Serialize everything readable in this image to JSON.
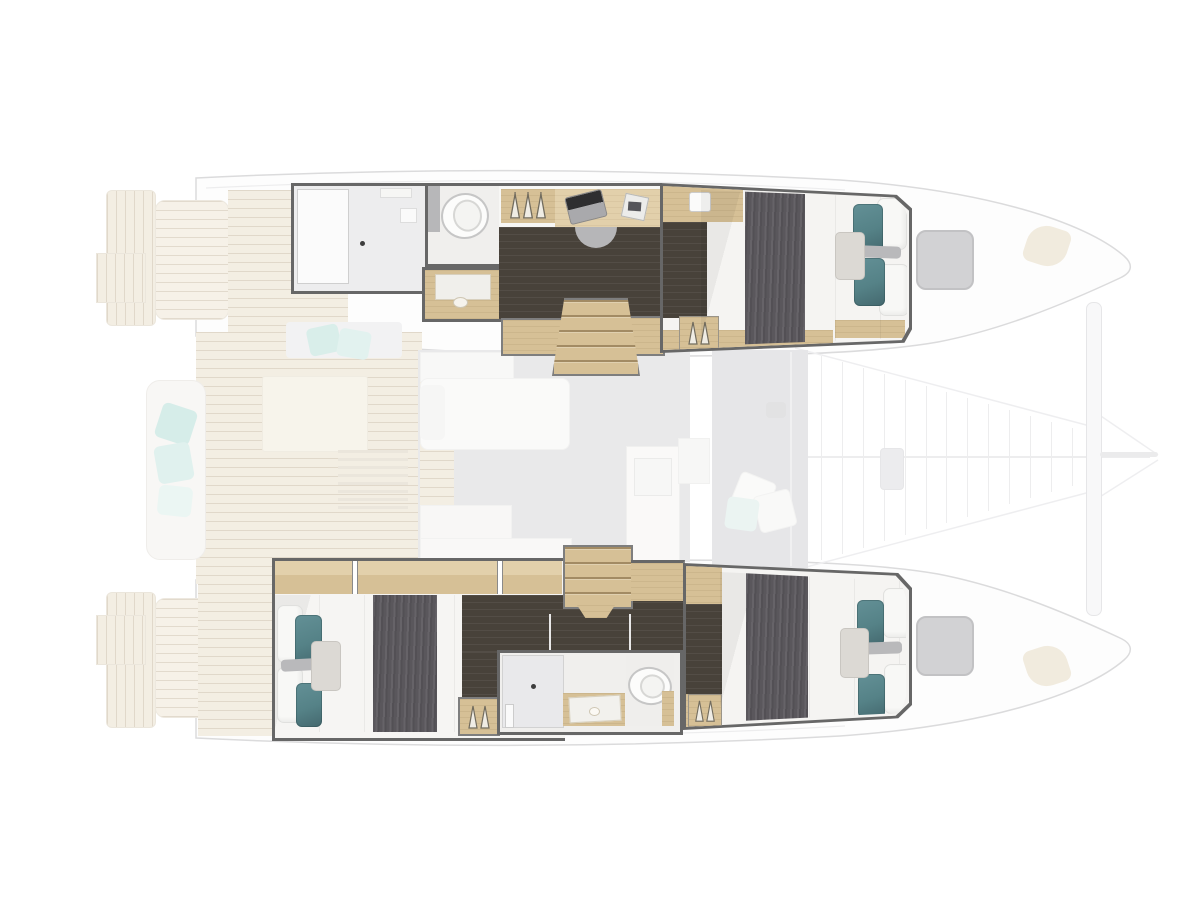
{
  "meta": {
    "description": "Catamaran yacht top-down deck plan with the two hull cabin layouts highlighted",
    "view": "top-down-floor-plan"
  },
  "palette": {
    "wall": "#676767",
    "wood": "#d6c096",
    "wood_light": "#e2d0ab",
    "wood_pale": "#e9dfc9",
    "floor_dark": "#48423a",
    "blanket": "#5a575c",
    "teal": "#558287",
    "teal_faded": "#b7dfd8",
    "mattress": "#f6f5f3",
    "pillow_grey": "#dcd9d4",
    "shower": "#e9e9eb",
    "bath": "#f0efed",
    "grey_floor": "#d4d4d7",
    "cockpit_grey": "#cfcfd3",
    "hatch": "#d2d2d4",
    "outline": "#b8b8bb",
    "chair": "#b6b6b8",
    "toilet_rim": "#c6c6c6"
  },
  "trampoline": {
    "lacing_lines": 14
  },
  "sections": {
    "top_hull": {
      "rooms": [
        "shower",
        "toilet",
        "vanity-basin",
        "wardrobe",
        "desk",
        "office-chair",
        "companionway-stairs",
        "double-berth"
      ]
    },
    "bottom_hull": {
      "rooms": [
        "double-berth-aft",
        "companionway-stairs",
        "shower",
        "vanity-basin",
        "toilet",
        "wardrobe",
        "double-berth-forward"
      ]
    },
    "faded": {
      "areas": [
        "swim-platforms",
        "aft-cockpit",
        "cockpit-bench",
        "cockpit-table",
        "saloon",
        "galley",
        "forward-cockpit",
        "trampoline",
        "deck-hatches",
        "crossbeam"
      ]
    }
  }
}
